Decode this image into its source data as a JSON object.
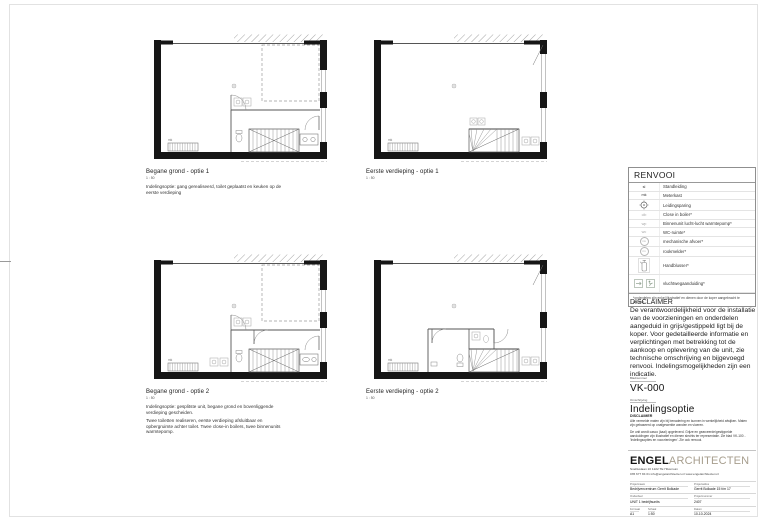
{
  "plans": [
    {
      "title": "Begane grond - optie 1",
      "scale": "1 : 50",
      "note": "Indelingsoptie: gang gerealiseerd, toilet geplaatst en keuken op de eerste verdieping",
      "note2": ""
    },
    {
      "title": "Eerste verdieping - optie 1",
      "scale": "1 : 50",
      "note": "",
      "note2": ""
    },
    {
      "title": "Begane grond - optie 2",
      "scale": "1 : 50",
      "note": "Indelingsoptie: gesplitste unit, begane grond en bovenliggende verdieping gescheiden.",
      "note2": "Twee toiletten realiseren, eerste verdieping afsluitbaar en opbergruimte achter toilet. Twee close-in boilers, twee binnenunits warmtepomp."
    },
    {
      "title": "Eerste verdieping - optie 2",
      "scale": "1 : 50",
      "note": "",
      "note2": ""
    }
  ],
  "annotations": {
    "meterkast": "mk"
  },
  "legend": {
    "title": "RENVOOI",
    "rows": [
      {
        "symbol": "sl",
        "label": "Standleiding"
      },
      {
        "symbol": "mk",
        "label": "Meterkast"
      },
      {
        "symbol": "leidingsparing-icon",
        "label": "Leidingsparing"
      },
      {
        "symbol": "cib",
        "label": "Close in boiler*"
      },
      {
        "symbol": "wp",
        "label": "Binnenunit lucht-lucht warmtepomp*"
      },
      {
        "symbol": "wc",
        "label": "WC-ruimte*"
      },
      {
        "symbol": "mv",
        "label": "mechanische afvoer*"
      },
      {
        "symbol": "rm",
        "label": "rookmelder*"
      },
      {
        "symbol": "handblusser-icon",
        "label": "Handblusser*"
      },
      {
        "symbol": "vluchtweg-icon",
        "label": "vluchtwegaanduiding*"
      }
    ],
    "footnote": "*onderdelen zijn enkel illustratief en dienen door de koper aangebracht te worden."
  },
  "disclaimer": {
    "title": "DISCLAIMER",
    "body": "De verantwoordelijkheid voor de installatie van de voorzieningen en onderdelen aangeduid in grijs/gestippeld ligt bij de koper. Voor gedetailleerde informatie en verplichtingen met betrekking tot de aankoop en oplevering van de unit, zie technische omschrijving en bijgevoegd renvooi. Indelingsmogelijkheden zijn een indicatie."
  },
  "sheet_info": {
    "number_label": "Bladnummer",
    "number": "VK-000",
    "name_label": "Omschrijving",
    "name": "Indelingsoptie"
  },
  "fine_print": {
    "title": "DISCLAIMER",
    "p1": "Alle vermelde maten zijn bij benadering en kunnen in werkelijkheid afwijken. Maten zijn gebaseerd op onafgewerkte wanden en vloeren.",
    "p2": "De unit wordt casco (kaal) opgeleverd. Grijze en gearceerde/gestippelde aanduidingen zijn illustratief en dienen slechts ter representatie. Zie blad VK-100 - 'Indelingsopties en voorzieningen'. Zie ook renvooi."
  },
  "titleblock": {
    "firm_bold": "ENGEL",
    "firm_light": "ARCHITECTEN",
    "accent_color": "#a79e8e",
    "address": "Snelliuslaan 10 1222 TE Hilversum",
    "contact": "035 677 84 01   info@engelarchitecten.nl   www.engelarchitecten.nl",
    "fields": [
      {
        "label": "Projectnaam",
        "value": "Bedrijvencentrum Gerrit Bolkade"
      },
      {
        "label": "Projectadres",
        "value": "Gerrit Bolkade 15 t/m 17"
      },
      {
        "label": "Onderdeel",
        "value": "UNIT 1 bedrijfsunits"
      },
      {
        "label": "Projectnummer",
        "value": "2407"
      },
      {
        "label": "Formaat",
        "value": "A1"
      },
      {
        "label": "Schaal",
        "value": "1:50"
      },
      {
        "label": "Datum",
        "value": "10-10-2024"
      }
    ]
  }
}
